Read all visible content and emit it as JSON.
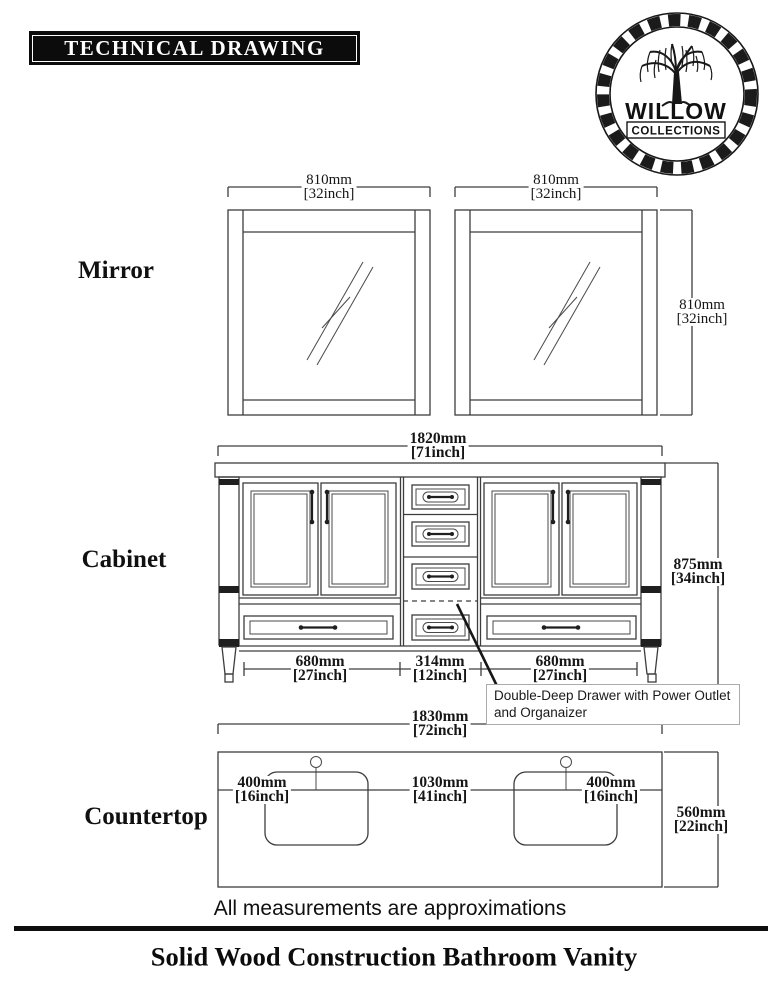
{
  "header": {
    "title": "TECHNICAL DRAWING",
    "logo": {
      "icon": "willow-tree-icon",
      "name": "WILLOW",
      "subname": "COLLECTIONS"
    }
  },
  "mirror": {
    "label": "Mirror",
    "left_width": {
      "mm": "810mm",
      "inch": "[32inch]"
    },
    "right_width": {
      "mm": "810mm",
      "inch": "[32inch]"
    },
    "height": {
      "mm": "810mm",
      "inch": "[32inch]"
    }
  },
  "cabinet": {
    "label": "Cabinet",
    "width": {
      "mm": "1820mm",
      "inch": "[71inch]"
    },
    "height": {
      "mm": "875mm",
      "inch": "[34inch]"
    },
    "bottom": [
      {
        "mm": "680mm",
        "inch": "[27inch]"
      },
      {
        "mm": "314mm",
        "inch": "[12inch]"
      },
      {
        "mm": "680mm",
        "inch": "[27inch]"
      }
    ],
    "callout_line1": "Double-Deep Drawer with Power Outlet",
    "callout_line2": "and Organaizer"
  },
  "countertop": {
    "label": "Countertop",
    "width": {
      "mm": "1830mm",
      "inch": "[72inch]"
    },
    "depth": {
      "mm": "560mm",
      "inch": "[22inch]"
    },
    "inner": [
      {
        "mm": "400mm",
        "inch": "[16inch]"
      },
      {
        "mm": "1030mm",
        "inch": "[41inch]"
      },
      {
        "mm": "400mm",
        "inch": "[16inch]"
      }
    ]
  },
  "footer": {
    "note": "All measurements are approximations",
    "title": "Solid Wood Construction Bathroom Vanity"
  },
  "colors": {
    "line": "#3d3d3d",
    "text": "#141414",
    "callout_border": "#ababab"
  }
}
